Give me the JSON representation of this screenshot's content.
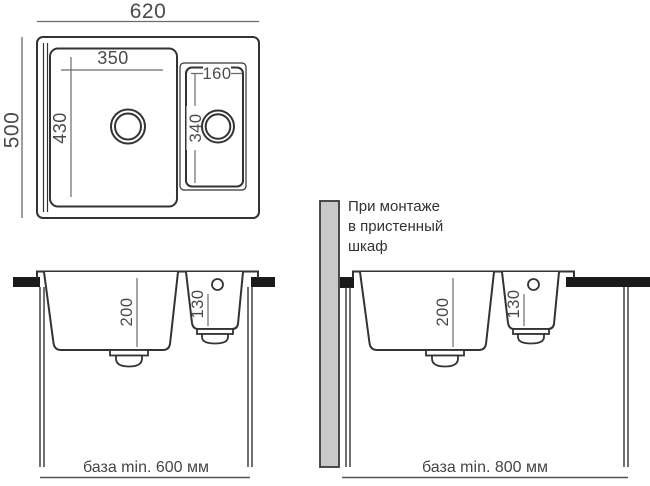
{
  "diagram_title": "sink-installation-dimensions",
  "colors": {
    "outline": "#333333",
    "dim_line": "#6a6a6a",
    "text": "#4a4a4a",
    "countertop": "#1a1a1a",
    "wall_panel_fill": "#c9c9c9",
    "wall_panel_stroke": "#3a3a3a",
    "background": "#ffffff"
  },
  "top_view": {
    "overall_width_mm": "620",
    "overall_depth_mm": "500",
    "main_bowl_width_mm": "350",
    "main_bowl_length_mm": "430",
    "small_bowl_width_mm": "160",
    "small_bowl_length_mm": "340"
  },
  "front_view_left": {
    "main_bowl_depth_mm": "200",
    "small_bowl_depth_mm": "130",
    "base_caption": "база min. 600 мм"
  },
  "front_view_right": {
    "main_bowl_depth_mm": "200",
    "small_bowl_depth_mm": "130",
    "base_caption": "база min. 800 мм",
    "note_lines": [
      "При монтаже",
      "в пристенный",
      "шкаф"
    ]
  }
}
